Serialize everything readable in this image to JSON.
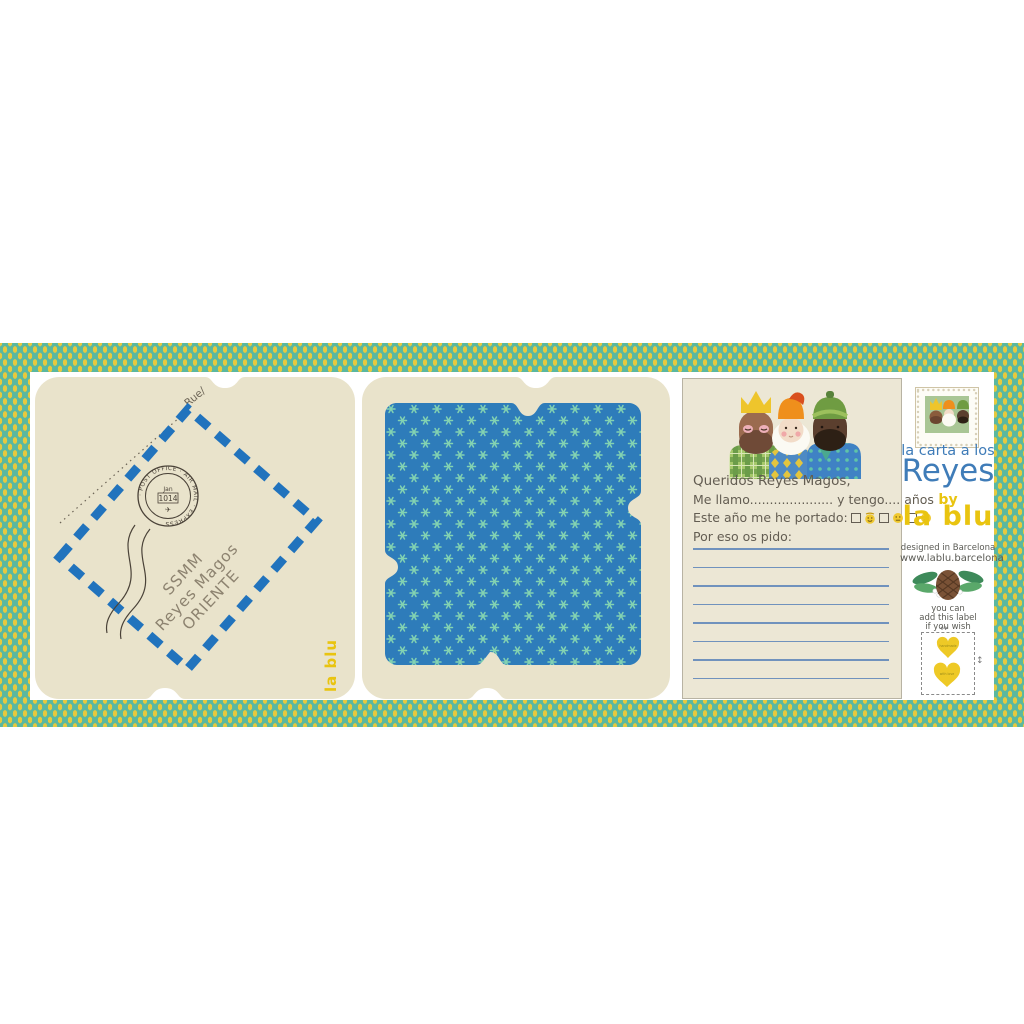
{
  "panel": {
    "border_teal": "#5ab8a0",
    "border_yellow": "#e6c93e",
    "cream": "#e9e3cb",
    "blue_fabric": "#2e7cba",
    "star_green": "#82d2b2",
    "airmail_blue": "#2173bd"
  },
  "envelope": {
    "route_label": "Rue/",
    "postmark_ring_text": "· POST OFFICE · AIR MAIL · EXPRESS",
    "postmark_month": "Jan",
    "postmark_year": "1014",
    "plane_icon": "✈",
    "address_line1": "SSMM",
    "address_line2": "Reyes Magos",
    "address_line3": "ORIENTE"
  },
  "brand_vertical": "la blu",
  "letter": {
    "greeting": "Queridos Reyes Magos,",
    "name_line": "Me llamo..................... y tengo.... años",
    "behaved_line": "Este año me he portado:",
    "request_line": "Por eso os pido:"
  },
  "sidebar": {
    "title_small": "la carta a los",
    "title_big": "Reyes",
    "by_label": "by",
    "brand": "la blu",
    "designed_line": "designed in Barcelona",
    "website": "www.lablu.barcelona",
    "note_line1": "you can",
    "note_line2": "add this label",
    "note_line3": "if you wish",
    "heart1_text": "handmade",
    "heart2_text": "with love",
    "h_arrow_icon": "↔",
    "v_arrow_icon": "↕"
  }
}
